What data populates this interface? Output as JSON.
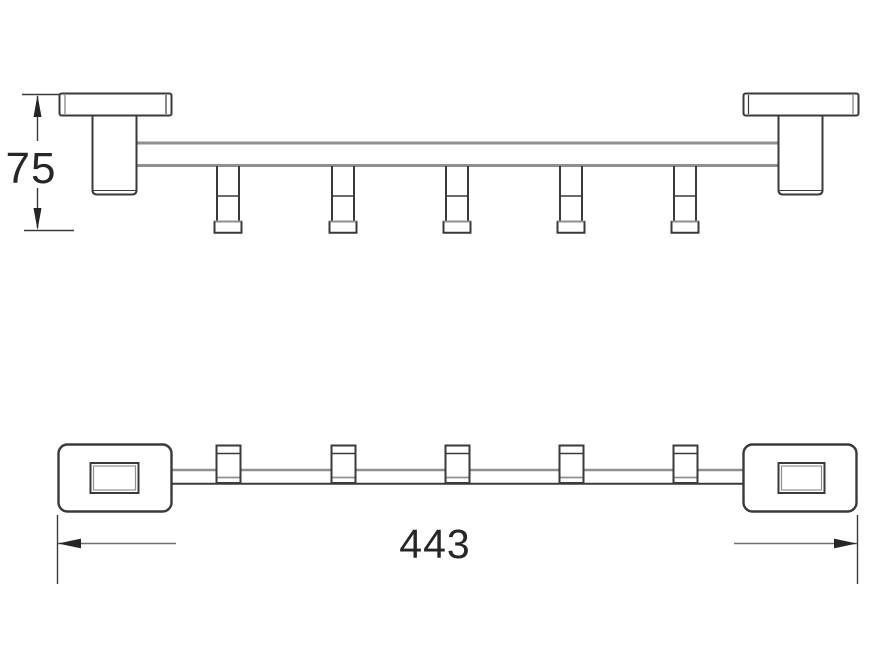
{
  "drawing": {
    "description": "Two-view technical line drawing of a wall-mounted 5-hook towel rail",
    "hook_count": 5,
    "dimensions": {
      "height": {
        "value": "75"
      },
      "length": {
        "value": "443"
      }
    },
    "colors": {
      "c-outline": "#3a3a3a",
      "c-secondary": "#8f8f8f",
      "c-dim": "#6e6e6e",
      "c-text": "#262626",
      "c-bg": "#ffffff"
    }
  }
}
